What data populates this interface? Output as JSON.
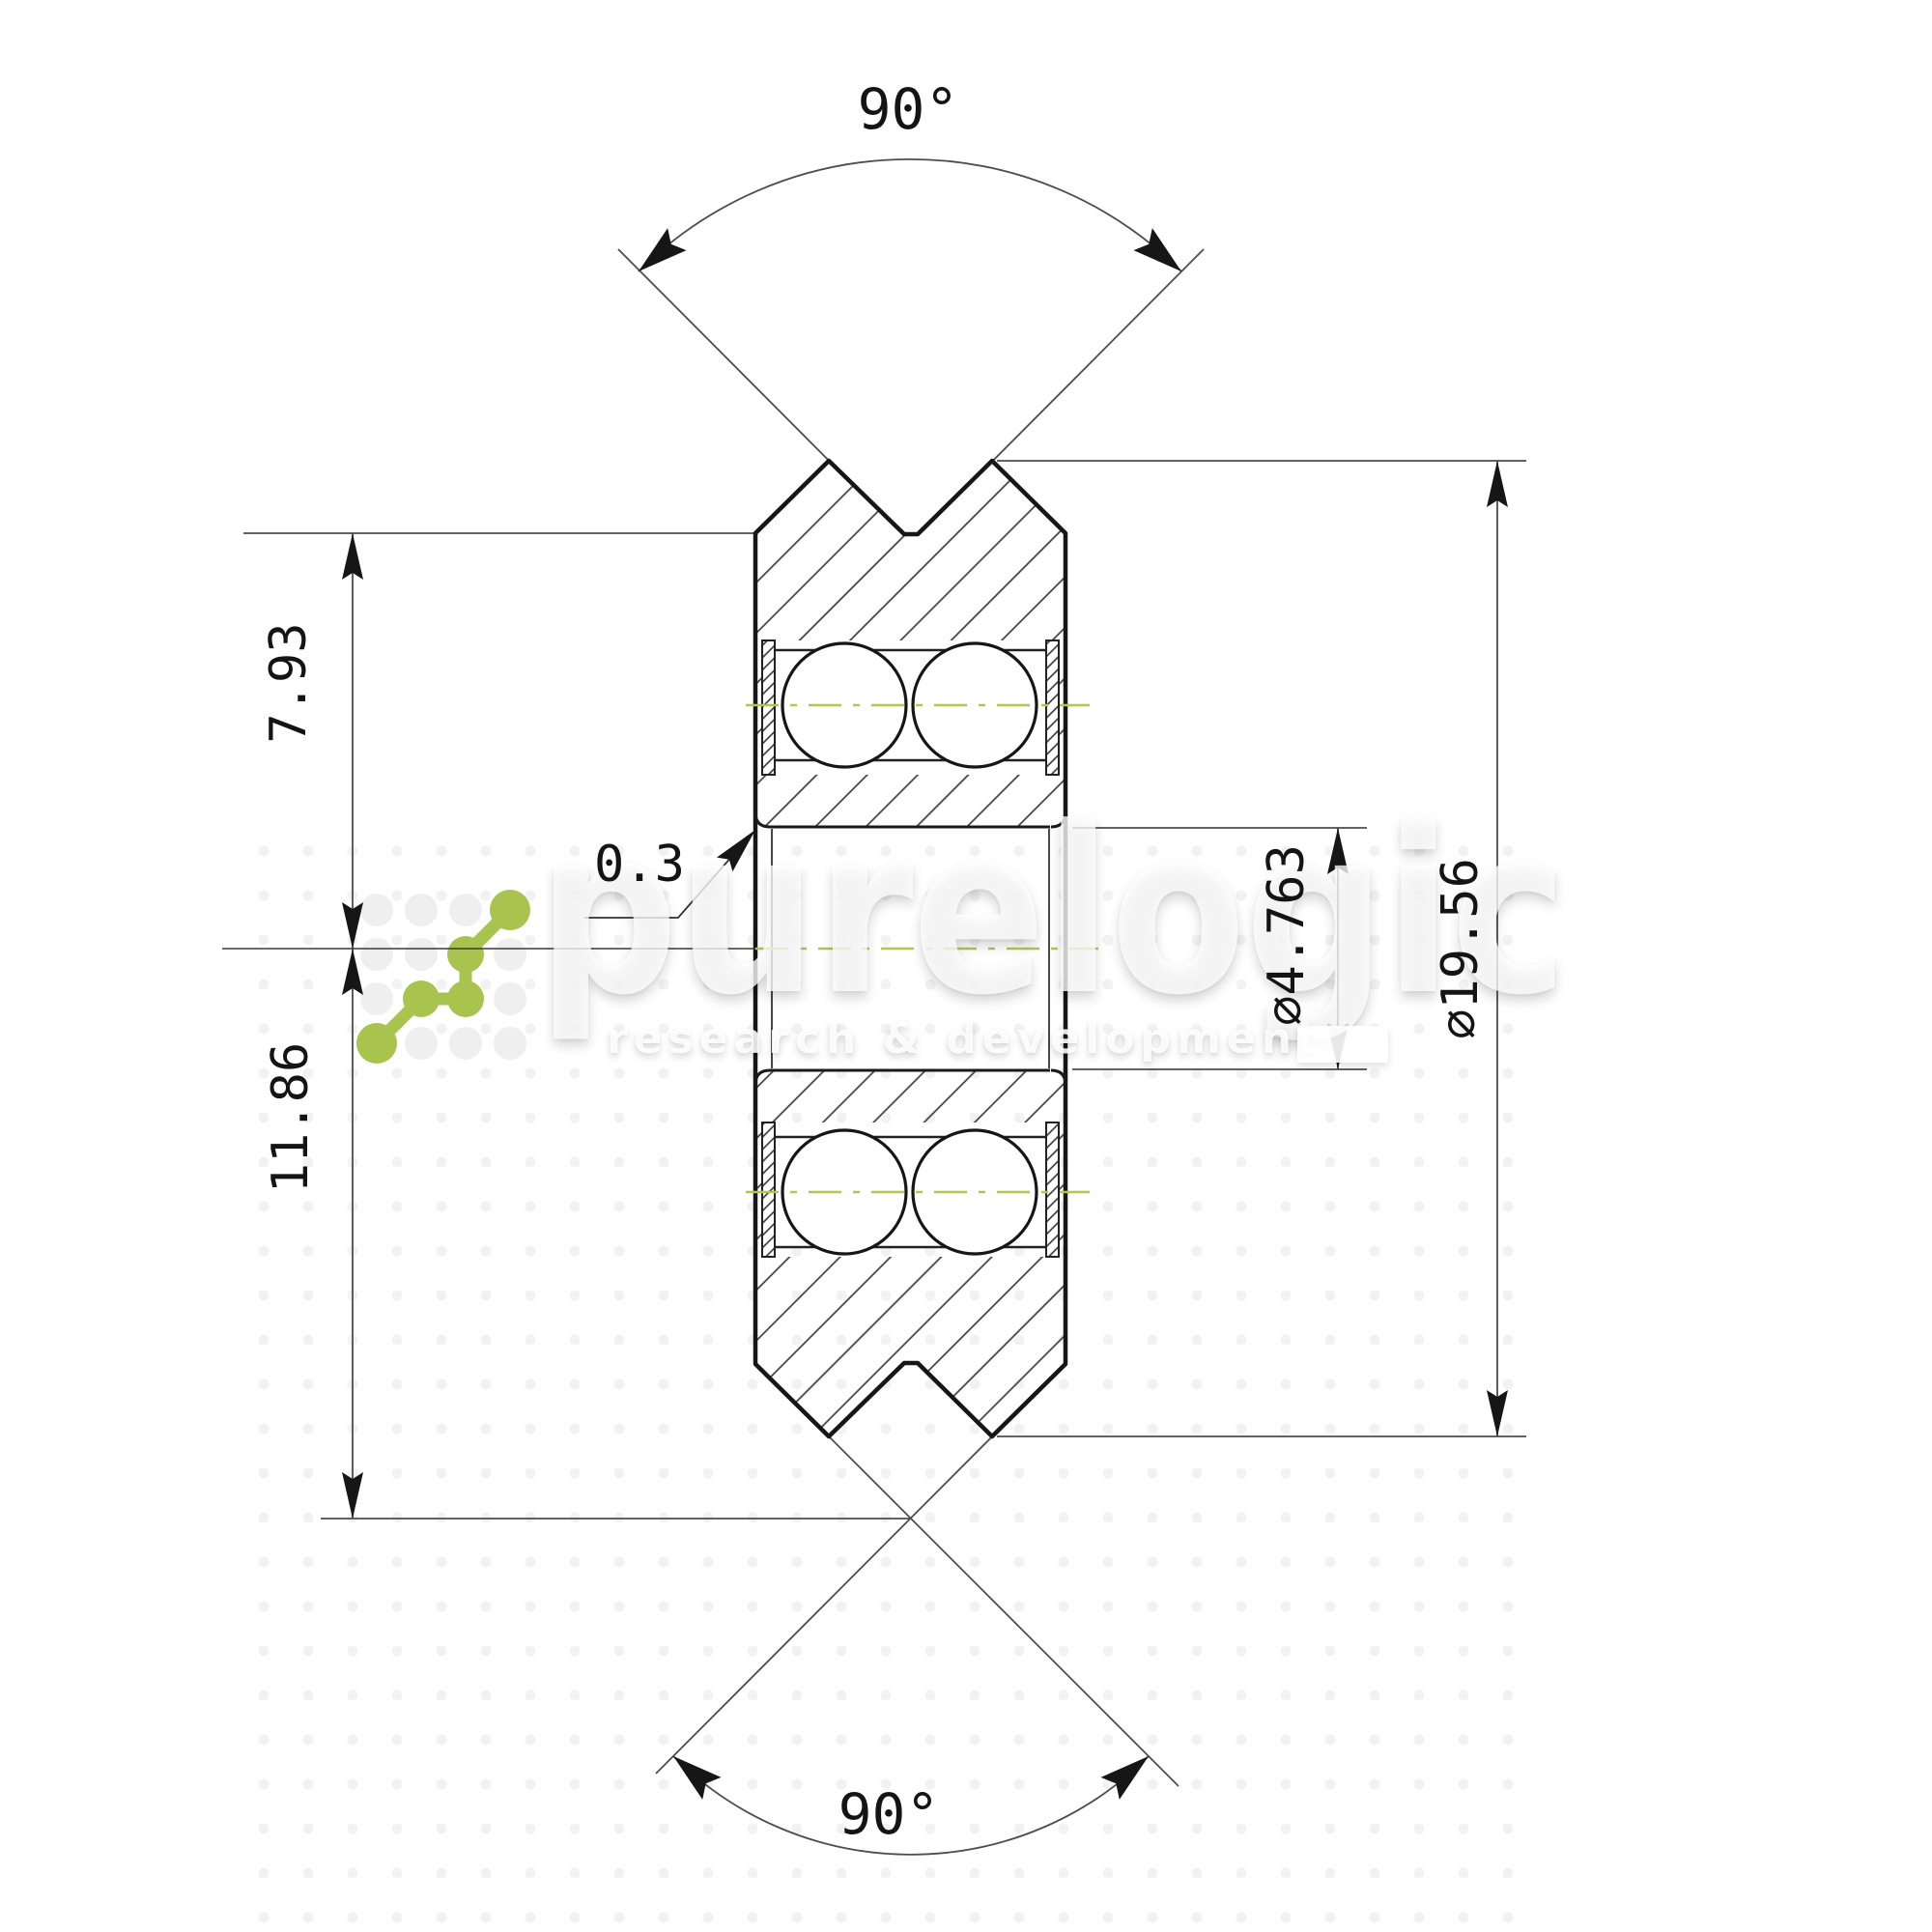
{
  "drawing": {
    "type": "technical-drawing",
    "subject": "V-groove wheel cross-section with two ball bearings",
    "background": "#ffffff",
    "dimensions": {
      "top_groove_angle": "90°",
      "bottom_groove_angle": "90°",
      "rim_to_axis": "7.93",
      "axis_to_v_apex": "11.86",
      "edge_radius": "0.3",
      "bore_diameter": "⌀4.763",
      "outer_diameter": "⌀19.56"
    },
    "colors": {
      "outline": "#161616",
      "dimension_lines": "#4d4d4d",
      "hatch": "#3d3d3d",
      "centerline_green": "#b6c64d",
      "logo_green": "#a8c34e"
    },
    "watermark": {
      "brand": "purelogic",
      "tagline": "research & development"
    }
  }
}
